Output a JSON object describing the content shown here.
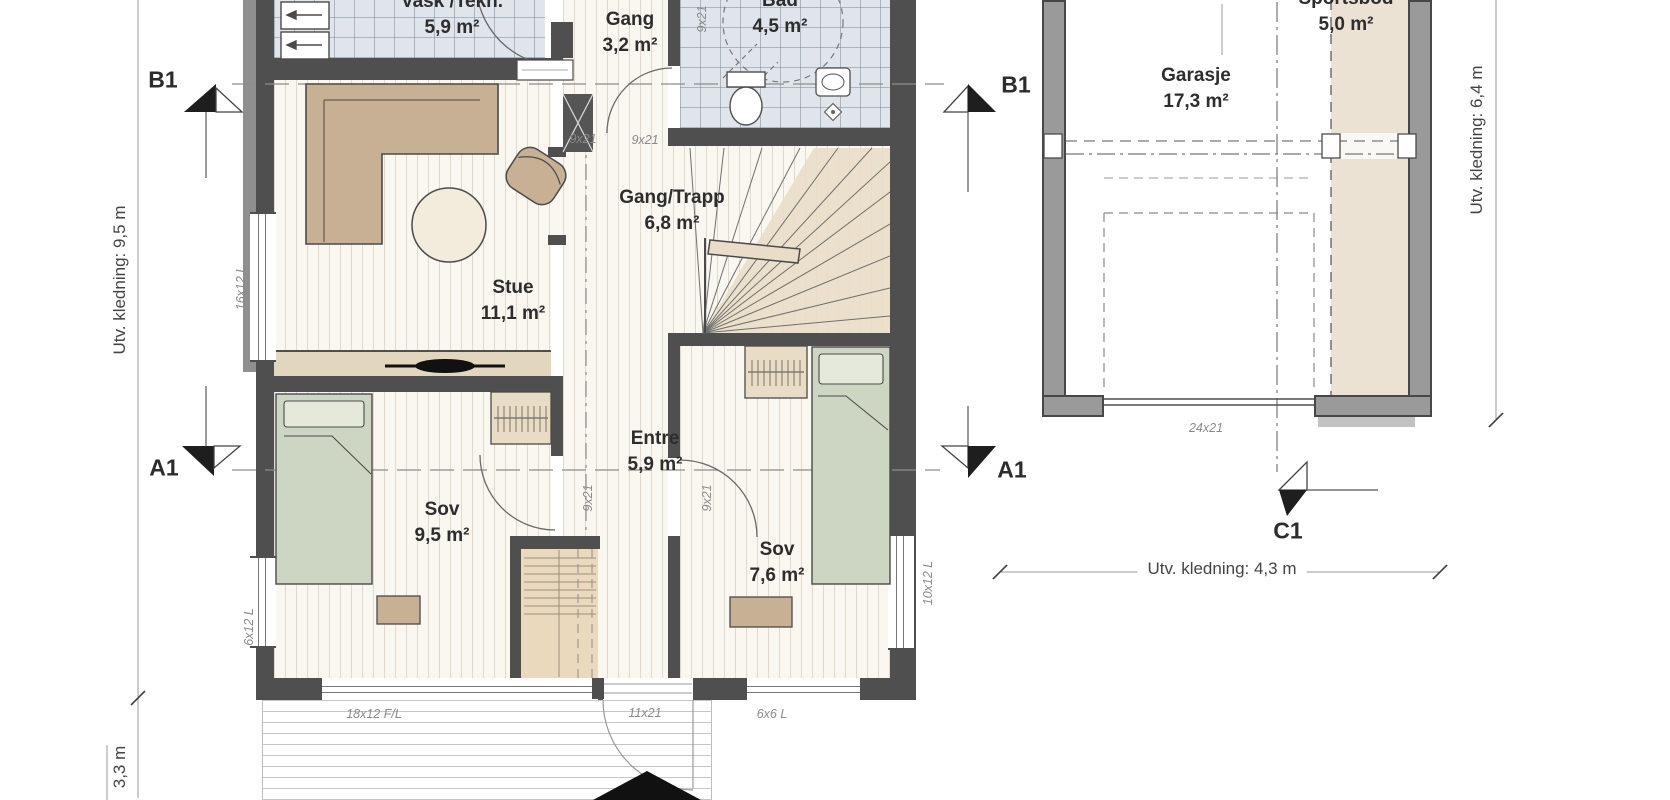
{
  "rooms": [
    {
      "name": "Vask /Tekn.",
      "area": "5,9 m²"
    },
    {
      "name": "Gang",
      "area": "3,2 m²"
    },
    {
      "name": "Bad",
      "area": "4,5 m²"
    },
    {
      "name": "Stue",
      "area": "11,1 m²"
    },
    {
      "name": "Gang/Trapp",
      "area": "6,8 m²"
    },
    {
      "name": "Entre",
      "area": "5,9 m²"
    },
    {
      "name": "Sov",
      "area": "9,5 m²"
    },
    {
      "name": "Sov",
      "area": "7,6 m²"
    },
    {
      "name": "Garasje",
      "area": "17,3 m²"
    },
    {
      "name": "Sportsbod",
      "area": "5,0 m²"
    }
  ],
  "dimensions": {
    "left": "Utv. kledning: 9,5 m",
    "left_lower": "3,3 m",
    "right": "Utv. kledning: 6,4 m",
    "garage_width": "Utv. kledning: 4,3 m"
  },
  "markers": {
    "b1": "B1",
    "a1": "A1",
    "c1": "C1"
  },
  "openings": {
    "door": "9x21",
    "entry_door": "11x21",
    "garage_door": "24x21",
    "window_stue": "16x12 L",
    "window_sov_left": "6x12 L",
    "window_front": "18x12 F/L",
    "window_sov2_front": "6x6 L",
    "window_sov2_right": "10x12 L"
  },
  "colors": {
    "wall": "#4f4f4f",
    "garage_wall": "#9a9a9a",
    "floor_tile": "#dfe5ea",
    "floor_stripe_base": "#faf6f0",
    "furniture_tan": "#c7b094",
    "bed_green": "#cdd6c3",
    "accent_beige": "#e9ddc8"
  }
}
